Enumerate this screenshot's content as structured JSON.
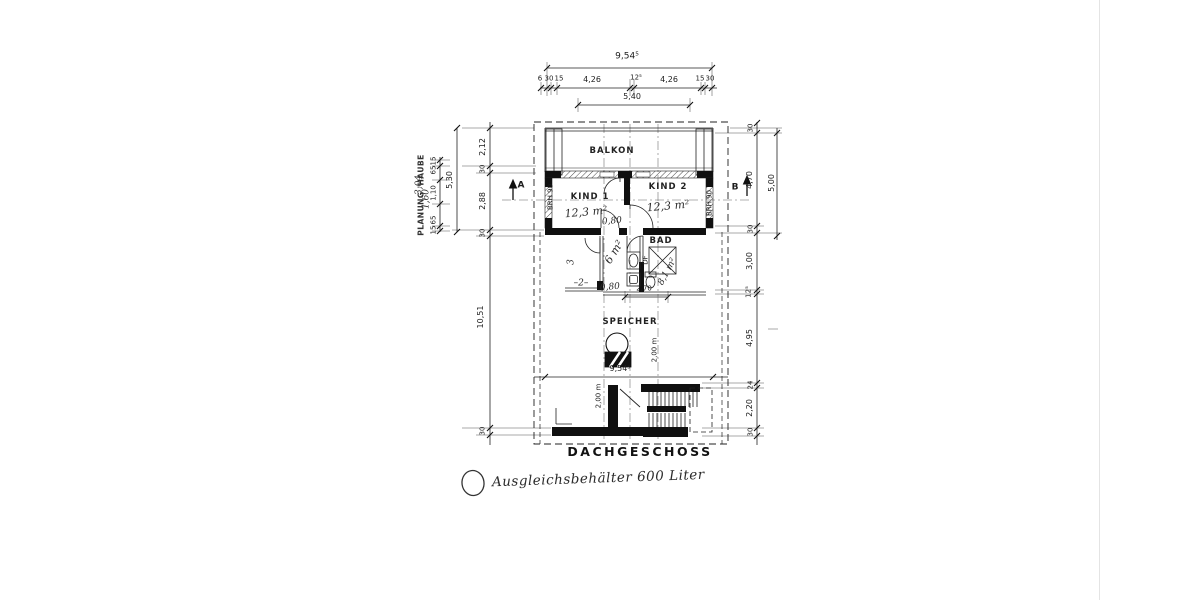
{
  "floor_title": "DACHGESCHOSS",
  "annotation": {
    "note": "Ausgleichsbehälter 600 Liter"
  },
  "rooms": {
    "balkon": "BALKON",
    "kind1": "KIND 1",
    "kind1_area": "12,3 m²",
    "kind2": "KIND 2",
    "kind2_area": "12,3 m²",
    "bad": "BAD",
    "bad_area": "8,1 m²",
    "hall_area": "6 m²",
    "speicher": "SPEICHER",
    "roof_window": "DF",
    "sill_left": "BRH 90",
    "sill_right": "BRH 90",
    "room_width_note": "–2–",
    "room_depth_note": "3"
  },
  "sections": {
    "a": "A",
    "b": "B"
  },
  "dims": {
    "top": {
      "total": "9,54⁵",
      "d6": "6",
      "d30_l": "30",
      "d15_l": "15",
      "d426_l": "4,26",
      "d125": "12⁵",
      "d426_r": "4,26",
      "d15_r": "15",
      "d30_r": "30",
      "d540": "5,40"
    },
    "left": {
      "stamp": "PLANUNG 'HAUBE",
      "d530": "5,30",
      "d212": "2,12",
      "d30_a": "30",
      "d288": "2,88",
      "d30_b": "30",
      "d1051": "10,51",
      "d30_c": "30",
      "d15_a": "15",
      "d65_a": "65",
      "d110": "1,10",
      "d65_b": "65",
      "d15_b": "15",
      "hw_160": "1,60",
      "hw_304": "3,04"
    },
    "right": {
      "d30_a": "30",
      "d470": "4,70",
      "d500": "5,00",
      "d30_b": "30",
      "d300": "3,00",
      "d125": "12⁵",
      "d495": "4,95",
      "d24": "24",
      "d220": "2,20",
      "d30_c": "30"
    },
    "inner": {
      "door_a": "0,80",
      "door_b": "0,80",
      "d270": "2,70",
      "total": "9,54⁵",
      "height_a": "2,00 m",
      "height_b": "2,00 m"
    }
  },
  "ink": {
    "line": "#1c1c1c",
    "poche": "#101010",
    "paper": "#ffffff"
  }
}
